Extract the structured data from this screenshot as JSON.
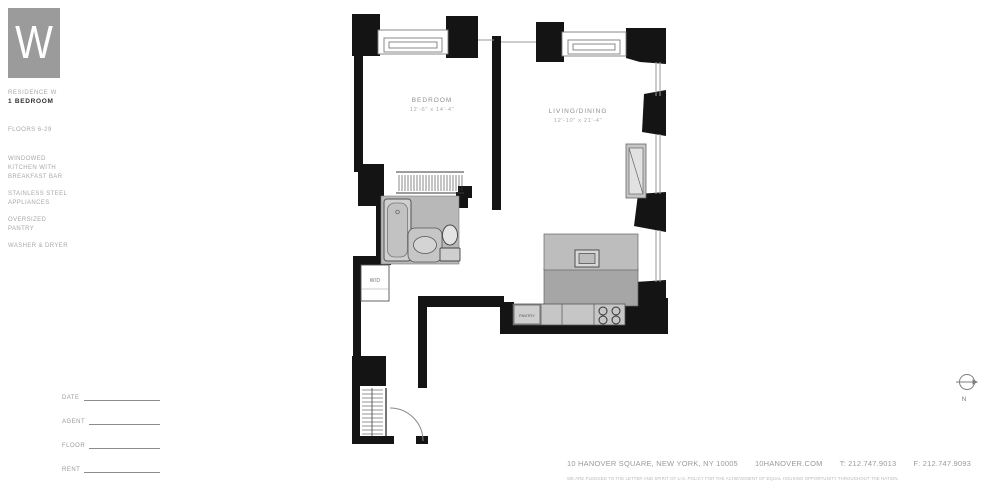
{
  "logo": {
    "letter": "W"
  },
  "sidebar": {
    "residence_label": "RESIDENCE W",
    "unit_type": "1 BEDROOM",
    "floors": "FLOORS 6-29",
    "features": [
      "WINDOWED KITCHEN WITH BREAKFAST BAR",
      "STAINLESS STEEL APPLIANCES",
      "OVERSIZED PANTRY",
      "WASHER & DRYER"
    ]
  },
  "form": {
    "fields": [
      "DATE",
      "AGENT",
      "FLOOR",
      "RENT"
    ]
  },
  "plan": {
    "bedroom": {
      "label": "BEDROOM",
      "dims": "12'-6\" x 14'-4\""
    },
    "living": {
      "label": "LIVING/DINING",
      "dims": "12'-10\" x 21'-4\""
    },
    "wd_label": "W/D",
    "pantry_label": "PANTRY",
    "north_label": "N"
  },
  "footer": {
    "address": "10 HANOVER SQUARE, NEW YORK, NY 10005",
    "website": "10HANOVER.COM",
    "phone": "T: 212.747.9013",
    "fax": "F: 212.747.9093",
    "disclaimer": "WE ARE PLEDGED TO THE LETTER AND SPIRIT OF U.S. POLICY FOR THE ACHIEVEMENT OF EQUAL HOUSING OPPORTUNITY THROUGHOUT THE NATION."
  }
}
